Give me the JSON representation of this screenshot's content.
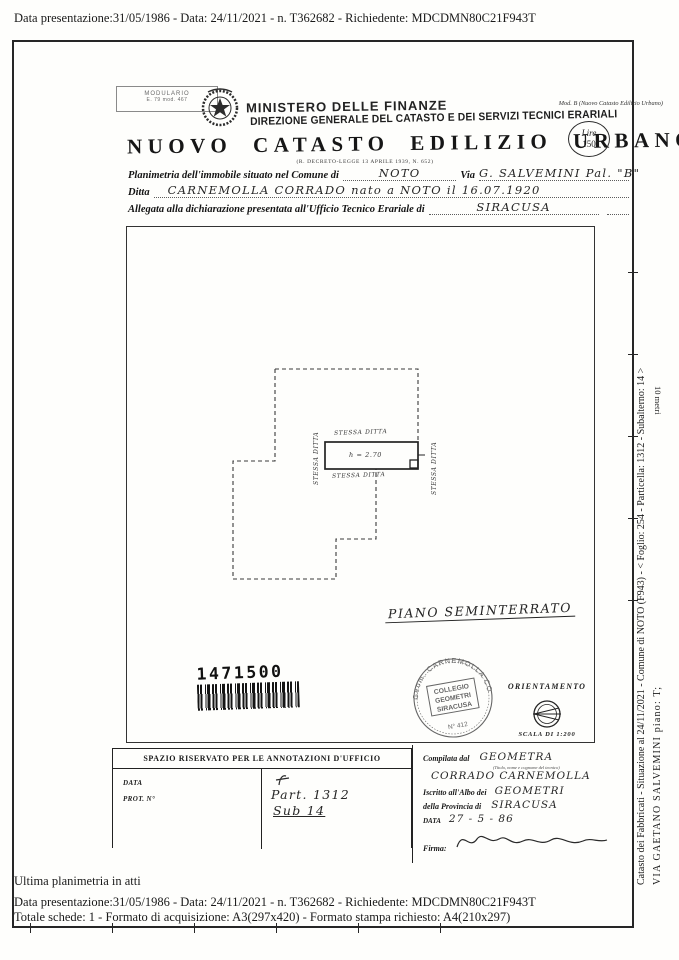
{
  "overlay": {
    "top_line": "Data presentazione:31/05/1986 - Data: 24/11/2021 - n. T362682 - Richiedente: MDCDMN80C21F943T",
    "bottom_note": "Ultima planimetria in atti",
    "bottom_line1": "Data presentazione:31/05/1986 - Data: 24/11/2021 - n. T362682 - Richiedente: MDCDMN80C21F943T",
    "bottom_line2": "Totale schede: 1 - Formato di acquisizione: A3(297x420)  - Formato stampa richiesto: A4(210x297)"
  },
  "header": {
    "modulario_line1": "MODULARIO",
    "modulario_line2": "E. 79 mod. 467",
    "ministry": "MINISTERO DELLE FINANZE",
    "direction": "DIREZIONE GENERALE DEL CATASTO E DEI SERVIZI TECNICI ERARIALI",
    "title": "NUOVO CATASTO EDILIZIO URBANO",
    "subtitle": "(R. DECRETO-LEGGE 13 APRILE 1939, N. 652)",
    "mod_b": "Mod. B (Nuovo Catasto Edilizio Urbano)",
    "lire_line1": "Lire",
    "lire_line2": "150"
  },
  "form": {
    "line1_label": "Planimetria dell'immobile situato nel Comune di",
    "line1_value": "NOTO",
    "via_label": "Via",
    "via_value": "G. SALVEMINI  Pal. \"B\"",
    "line2_label": "Ditta",
    "line2_value": "CARNEMOLLA CORRADO   nato a NOTO   il 16.07.1920",
    "line3_label": "Allegata alla dichiarazione presentata all'Ufficio Tecnico Erariale di",
    "line3_value": "SIRACUSA"
  },
  "drawing": {
    "label_top": "STESSA DITTA",
    "label_left": "STESSA DITTA",
    "label_bottom": "STESSA DITTA",
    "label_right": "STESSA DITTA",
    "room_height": "h = 2.70",
    "floor_label": "PIANO SEMINTERRATO",
    "barcode_number": "1471500",
    "orientation_label": "ORIENTAMENTO",
    "scale_label": "SCALA DI 1:200",
    "ruler_label": "10 metri"
  },
  "stamp": {
    "ring_text": "Geom. CARNEMOLLA CORRADO",
    "line1": "COLLEGIO",
    "line2": "GEOMETRI",
    "line3": "SIRACUSA",
    "number": "N° 412"
  },
  "annotations_box": {
    "header": "SPAZIO RISERVATO PER LE ANNOTAZIONI D'UFFICIO",
    "data_label": "DATA",
    "prot_label": "PROT. N°",
    "handwritten1": "Part. 1312",
    "handwritten2": "Sub 14"
  },
  "compiler_box": {
    "compiled_label": "Compilata dal",
    "compiled_value": "GEOMETRA",
    "compiled_note": "(Titolo, nome e cognome del tecnico)",
    "compiled_name": "CORRADO CARNEMOLLA",
    "albo_label": "Iscritto all'Albo dei",
    "albo_value": "GEOMETRI",
    "provincia_label": "della Provincia di",
    "provincia_value": "SIRACUSA",
    "data_label": "DATA",
    "data_value": "27 - 5 - 86",
    "firma_label": "Firma:"
  },
  "sidebar": {
    "line1": "Catasto dei Fabbricati - Situazione al 24/11/2021 - Comune di NOTO (F943) - < Foglio: 254 - Particella: 1312 - Subalterno: 14 >",
    "line2": "VIA GAETANO SALVEMINI piano: T;"
  }
}
